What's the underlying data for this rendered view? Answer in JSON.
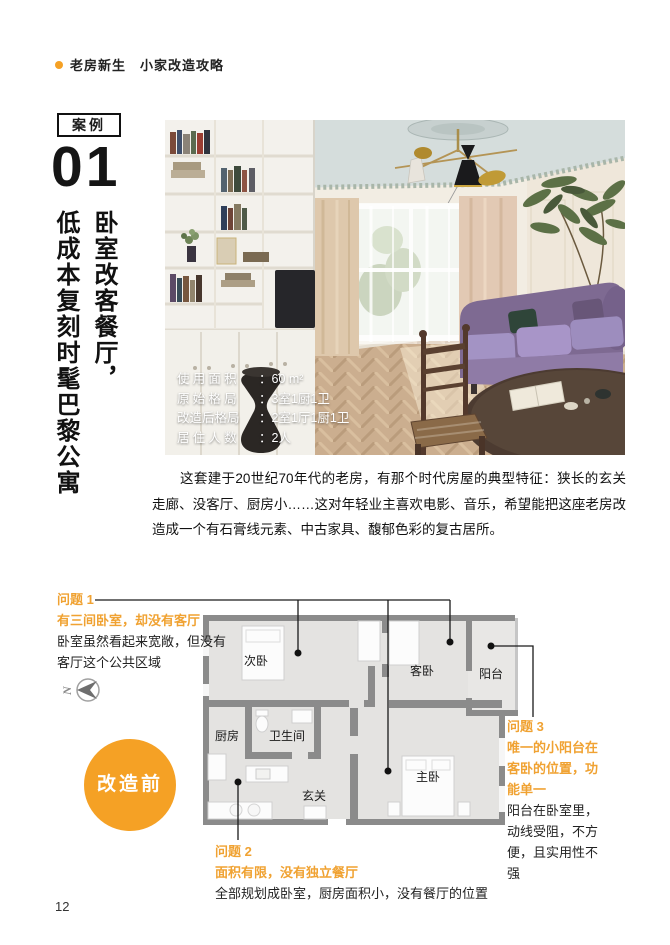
{
  "theme": {
    "accent": "#F5A125",
    "accent-text": "#F0A232",
    "wall": "#8B8B8B",
    "roomfill": "#E4E3E1",
    "ink": "#1A1A1A"
  },
  "header": {
    "series": "老房新生",
    "subtitle": "小家改造攻略"
  },
  "case": {
    "badge": "案例",
    "number": "01",
    "title_line1": "卧室改客餐厅，",
    "title_line2": "低成本复刻时髦巴黎公寓"
  },
  "photo": {
    "info": [
      {
        "label": "使用面积",
        "colon": "：",
        "value": "60 m²"
      },
      {
        "label": "原始格局",
        "colon": "：",
        "value": "3室1厨1卫"
      },
      {
        "label": "改造后格局",
        "colon": "：",
        "value": "2室1厅1厨1卫"
      },
      {
        "label": "居住人数",
        "colon": "：",
        "value": "2人"
      }
    ]
  },
  "intro": "这套建于20世纪70年代的老房，有那个时代房屋的典型特征：狭长的玄关走廊、没客厅、厨房小……这对年轻业主喜欢电影、音乐，希望能把这座老房改造成一个有石膏线元素、中古家具、馥郁色彩的复古居所。",
  "floorplan": {
    "stage_label": "改造前",
    "compass": "N",
    "rooms": {
      "second_bedroom": "次卧",
      "guest_bedroom": "客卧",
      "balcony": "阳台",
      "kitchen": "厨房",
      "bathroom": "卫生间",
      "hallway": "玄关",
      "master_bedroom": "主卧"
    },
    "problems": [
      {
        "id": "问题 1",
        "headline": "有三间卧室，却没有客厅",
        "detail": "卧室虽然看起来宽敞，但没有客厅这个公共区域"
      },
      {
        "id": "问题 2",
        "headline": "面积有限，没有独立餐厅",
        "detail": "全部规划成卧室，厨房面积小，没有餐厅的位置"
      },
      {
        "id": "问题 3",
        "headline": "唯一的小阳台在客卧的位置，功能单一",
        "detail": "阳台在卧室里，动线受阻，不方便，且实用性不强"
      }
    ]
  },
  "page": {
    "number": "12"
  }
}
